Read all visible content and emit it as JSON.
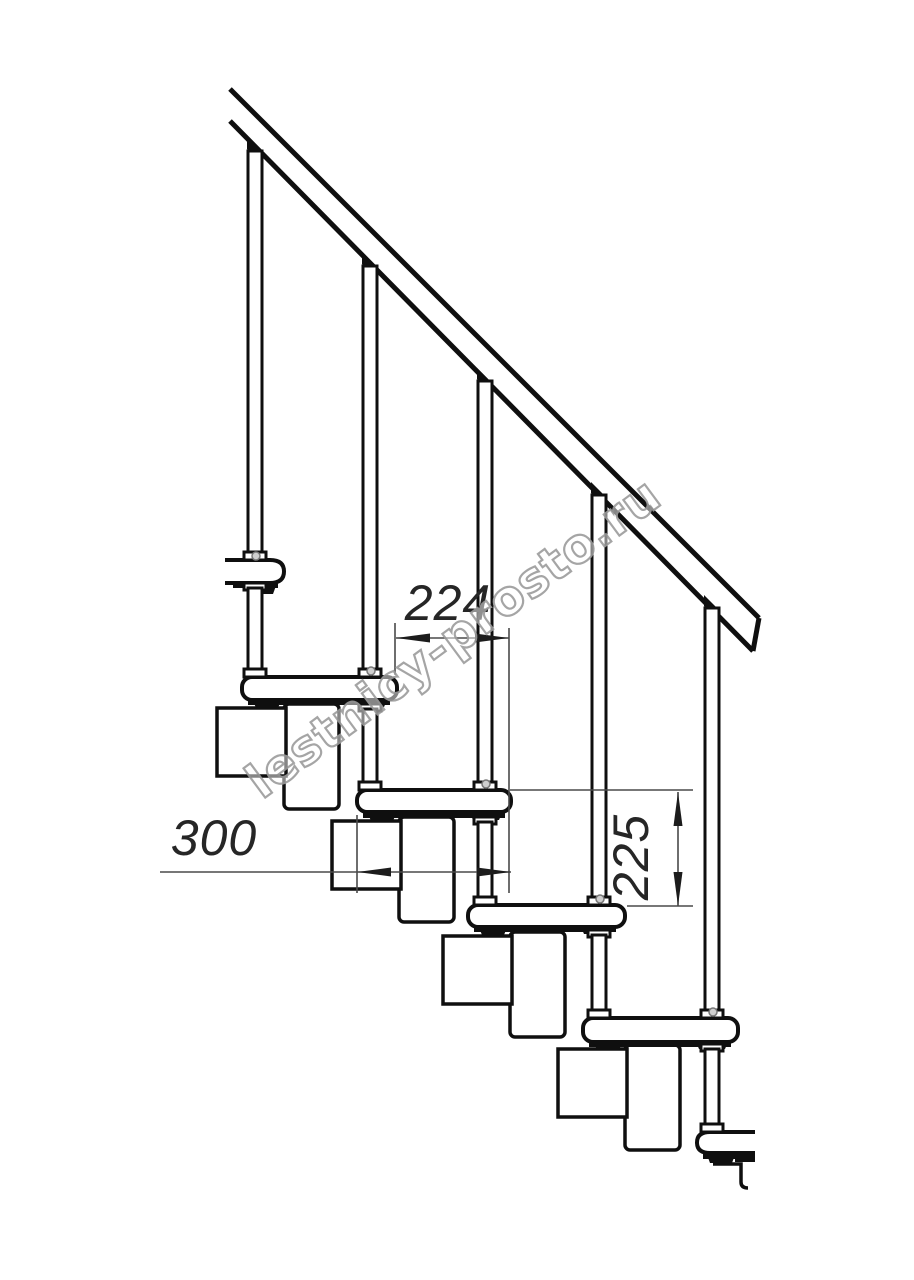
{
  "drawing": {
    "type": "modular staircase side elevation",
    "watermark": "lestnicy-prosto.ru",
    "dimensions": {
      "step_run": "224",
      "tread_depth": "300",
      "riser_height": "225"
    },
    "colors": {
      "background": "#ffffff",
      "line": "#0f0f0f",
      "dim_line": "#4a4a4a",
      "dim_text": "#262626",
      "watermark_stroke": "#9c9c9c"
    }
  }
}
